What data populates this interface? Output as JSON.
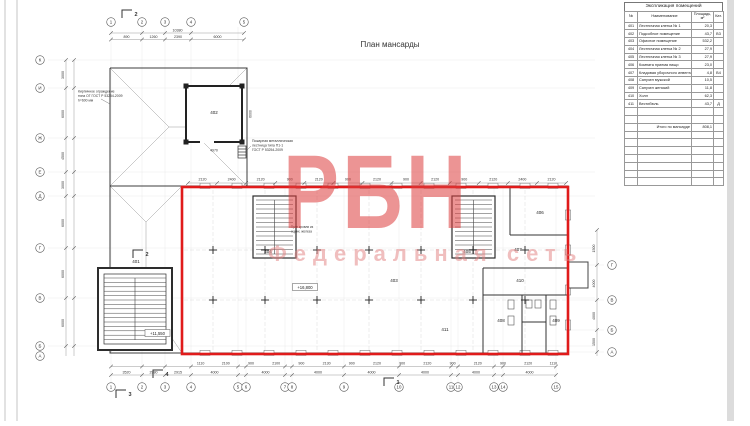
{
  "drawing": {
    "title": "План мансарды",
    "annotations": {
      "fence": [
        "Кирпичное ограждение",
        "типа ОГ ГОСТ Р 53254-2009",
        "h=600 мм"
      ],
      "fire_ladder": [
        "Пожарная металлическая",
        "лестница типа П1-1",
        "ГОСТ Р 53254-2009"
      ],
      "roof_note": [
        "Трап кровли из",
        "оцинк. железа"
      ]
    },
    "elevations": [
      "+16,800",
      "+11,550"
    ],
    "room_labels": [
      "401",
      "402",
      "403",
      "404",
      "405",
      "406",
      "407",
      "408",
      "409",
      "410",
      "411"
    ],
    "section_marks": [
      "2",
      "2",
      "3",
      "4",
      "1"
    ]
  },
  "axes": {
    "bottom": [
      "1",
      "2",
      "3",
      "4",
      "5",
      "6",
      "7",
      "8",
      "9",
      "10",
      "11",
      "12",
      "13",
      "14",
      "15"
    ],
    "top": [
      "1",
      "2",
      "3",
      "4",
      "5"
    ],
    "left": [
      "К",
      "И",
      "Ж",
      "Е",
      "Д",
      "Г",
      "В",
      "Б",
      "А"
    ],
    "right": [
      "Г",
      "В",
      "Б",
      "А"
    ]
  },
  "dimensions": {
    "window_row": [
      "2120",
      "2400",
      "2120",
      "900",
      "2120",
      "900",
      "2120",
      "900",
      "2120",
      "900",
      "2120",
      "2400",
      "2120"
    ],
    "bottom_row1": [
      "1110",
      "2100",
      "900",
      "2100",
      "900",
      "2130",
      "900",
      "2120",
      "900",
      "2120",
      "900",
      "2120",
      "900",
      "2120",
      "1110"
    ],
    "bottom_row2": [
      "3520",
      "2980",
      "2915",
      "4000",
      "4000",
      "4000",
      "4000",
      "4000",
      "4000",
      "4000"
    ],
    "top_row": [
      "890",
      "1260",
      "2390",
      "6000"
    ],
    "top_total": "10380",
    "left_col": [
      "3000",
      "6000",
      "4500",
      "3000",
      "6000",
      "6000",
      "6000"
    ],
    "right_col": [
      "1500",
      "4000",
      "4000",
      "1500"
    ],
    "misc": [
      "4970",
      "6000"
    ]
  },
  "watermark": {
    "logo": "РБН",
    "tagline": "Федеральная сеть",
    "color": "#dd3c3c"
  },
  "table": {
    "title": "Экспликация помещений",
    "headers": [
      "№",
      "Наименование",
      "Площадь, м²",
      "Кат."
    ],
    "rows": [
      [
        "401",
        "Лестничная клетка № 1",
        "20,3",
        ""
      ],
      [
        "402",
        "Подсобное помещение",
        "43,7",
        "В3"
      ],
      [
        "403",
        "Офисное помещение",
        "532,2",
        ""
      ],
      [
        "404",
        "Лестничная клетка № 2",
        "27,9",
        ""
      ],
      [
        "405",
        "Лестничная клетка № 3",
        "27,9",
        ""
      ],
      [
        "406",
        "Комната приема пищи",
        "23,0",
        ""
      ],
      [
        "407",
        "Кладовая уборочного инвентаря",
        "4,8",
        "В4"
      ],
      [
        "408",
        "Санузел мужской",
        "10,5",
        ""
      ],
      [
        "409",
        "Санузел женский",
        "11,8",
        ""
      ],
      [
        "410",
        "Холл",
        "62,3",
        ""
      ],
      [
        "411",
        "Вестибюль",
        "43,7",
        "Д"
      ]
    ],
    "total_label": "Итого по мансарде",
    "total_value": "808,1"
  }
}
